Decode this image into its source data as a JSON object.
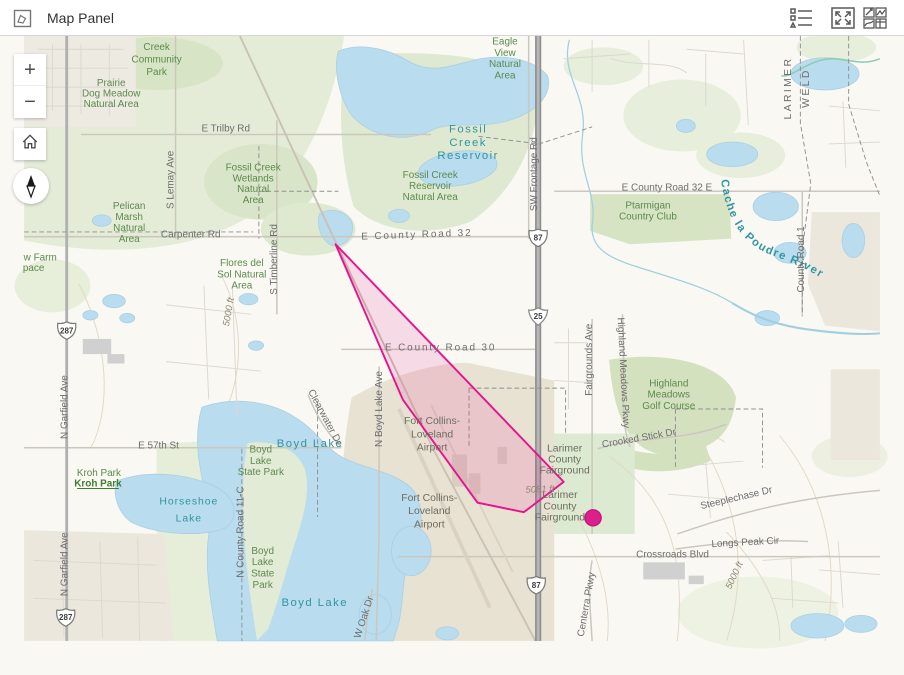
{
  "header": {
    "title": "Map Panel",
    "left_icon": "map-panel",
    "right_icons": [
      "legend",
      "fullscreen",
      "widget-gallery"
    ]
  },
  "controls": {
    "zoom_in": "+",
    "zoom_out": "−"
  },
  "overlay": {
    "polygon_color": "#e8128c",
    "polygon_fill": "rgba(232,18,140,0.13)",
    "marker_color": "#dd1f8d"
  },
  "shields": [
    {
      "type": "us-route",
      "number": "287"
    },
    {
      "type": "us-route",
      "number": "287"
    },
    {
      "type": "us-route",
      "number": "87"
    },
    {
      "type": "us-route",
      "number": "87"
    },
    {
      "type": "interstate",
      "number": "25"
    }
  ],
  "labels": {
    "parks": [
      {
        "lines": [
          "Creek",
          "Community",
          "Park"
        ]
      },
      {
        "lines": [
          "Prairie",
          "Dog Meadow",
          "Natural Area"
        ]
      },
      {
        "lines": [
          "Fossil Creek",
          "Wetlands",
          "Natural",
          "Area"
        ]
      },
      {
        "lines": [
          "Pelican",
          "Marsh",
          "Natural",
          "Area"
        ]
      },
      {
        "lines": [
          "Flores del",
          "Sol Natural",
          "Area"
        ]
      },
      {
        "lines": [
          "Fossil Creek",
          "Reservoir",
          "Natural Area"
        ]
      },
      {
        "lines": [
          "Eagle",
          "View",
          "Natural",
          "Area"
        ]
      },
      {
        "lines": [
          "Ptarmigan",
          "Country Club"
        ]
      },
      {
        "lines": [
          "Highland",
          "Meadows",
          "Golf Course"
        ]
      },
      {
        "lines": [
          "Kroh Park"
        ]
      },
      {
        "lines": [
          "Kroh Park"
        ]
      },
      {
        "lines": [
          "Boyd",
          "Lake",
          "State Park"
        ]
      },
      {
        "lines": [
          "Boyd",
          "Lake",
          "State",
          "Park"
        ]
      },
      {
        "lines": [
          "w Farm"
        ]
      },
      {
        "lines": [
          "pace"
        ]
      }
    ],
    "water": [
      {
        "lines": [
          "Fossil",
          "Creek",
          "Reservoir"
        ]
      },
      {
        "lines": [
          "Horseshoe",
          "Lake"
        ]
      },
      {
        "text": "Boyd Lake"
      },
      {
        "text": "Boyd Lake"
      }
    ],
    "river": "Cache la Poudre River",
    "roads": [
      {
        "text": "E Trilby Rd"
      },
      {
        "text": "S Lemay Ave"
      },
      {
        "text": "Carpenter Rd"
      },
      {
        "text": "S Timberline Rd"
      },
      {
        "text": "E County Road 32"
      },
      {
        "text": "E County Road 30"
      },
      {
        "text": "SW Frontage Rd"
      },
      {
        "text": "E County Road 32 E"
      },
      {
        "text": "County Road 1"
      },
      {
        "text": "LARIMER"
      },
      {
        "text": "WELD"
      },
      {
        "text": "Fairgrounds Ave"
      },
      {
        "text": "Highland Meadows Pkwy"
      },
      {
        "text": "Crooked Stick Dr"
      },
      {
        "text": "Steeplechase Dr"
      },
      {
        "text": "Longs Peak Cir"
      },
      {
        "text": "Crossroads Blvd"
      },
      {
        "text": "E 57th St"
      },
      {
        "text": "N Garfield Ave"
      },
      {
        "text": "N Garfield Ave"
      },
      {
        "text": "N County Road 11-C"
      },
      {
        "text": "N Boyd Lake Ave"
      },
      {
        "text": "Clearwater Dr"
      },
      {
        "text": "Centerra Pkwy"
      },
      {
        "text": "W Oak Dr"
      }
    ],
    "landmarks": [
      {
        "lines": [
          "Larimer",
          "County",
          "Fairground"
        ]
      },
      {
        "lines": [
          "Larimer",
          "County",
          "Fairground"
        ]
      },
      {
        "lines": [
          "Fort Collins-",
          "Loveland",
          "Airport"
        ]
      },
      {
        "lines": [
          "Fort Collins-",
          "Loveland",
          "Airport"
        ]
      }
    ],
    "contours": [
      {
        "text": "5081 ft"
      },
      {
        "text": "5000 ft"
      },
      {
        "text": "5000 ft"
      }
    ]
  }
}
